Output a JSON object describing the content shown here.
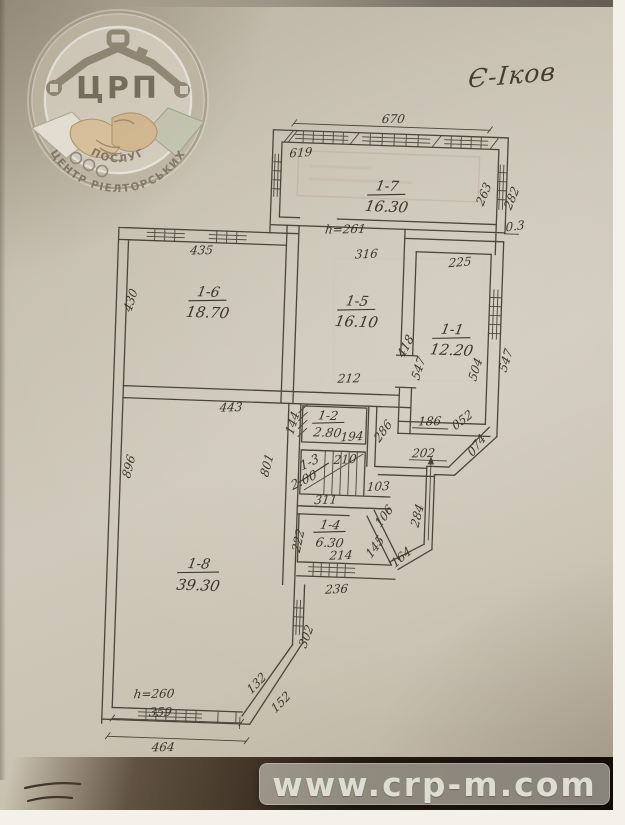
{
  "photo": {
    "annotation": "Є-Іков",
    "watermark_url": "www.crp-m.com"
  },
  "logo": {
    "abbr": "ЦРП",
    "arc_line1": "ЦЕНТР РІЕЛТОРСЬКИХ",
    "arc_line2": "ПОСЛУГ"
  },
  "plan": {
    "rooms": [
      {
        "id": "1-7",
        "area": "16.30"
      },
      {
        "id": "1-6",
        "area": "18.70"
      },
      {
        "id": "1-5",
        "area": "16.10"
      },
      {
        "id": "1-1",
        "area": "12.20"
      },
      {
        "id": "1-2",
        "area": "2.80"
      },
      {
        "id": "1-3",
        "area": "2.00"
      },
      {
        "id": "1-4",
        "area": "6.30"
      },
      {
        "id": "1-8",
        "area": "39.30"
      }
    ],
    "heights": {
      "h1": "h=261",
      "h2": "h=260"
    },
    "dims": {
      "d670": "670",
      "d619": "619",
      "d263": "263",
      "d282": "282",
      "d03": "0.3",
      "d435": "435",
      "d430": "430",
      "d316": "316",
      "d225": "225",
      "d418": "418",
      "d547a": "547",
      "d504": "504",
      "d547b": "547",
      "d212": "212",
      "d186": "186",
      "d052": "052",
      "d443": "443",
      "d144": "144",
      "d194": "194",
      "d286": "286",
      "d202": "202",
      "d074": "074",
      "d210": "210",
      "d103": "103",
      "d311": "311",
      "d222": "222",
      "d145": "145",
      "d106": "106",
      "d164": "164",
      "d214": "214",
      "d236": "236",
      "d284": "284",
      "d896": "896",
      "d801": "801",
      "d302": "302",
      "d132": "132",
      "d152": "152",
      "d359": "359",
      "d464": "464"
    }
  }
}
